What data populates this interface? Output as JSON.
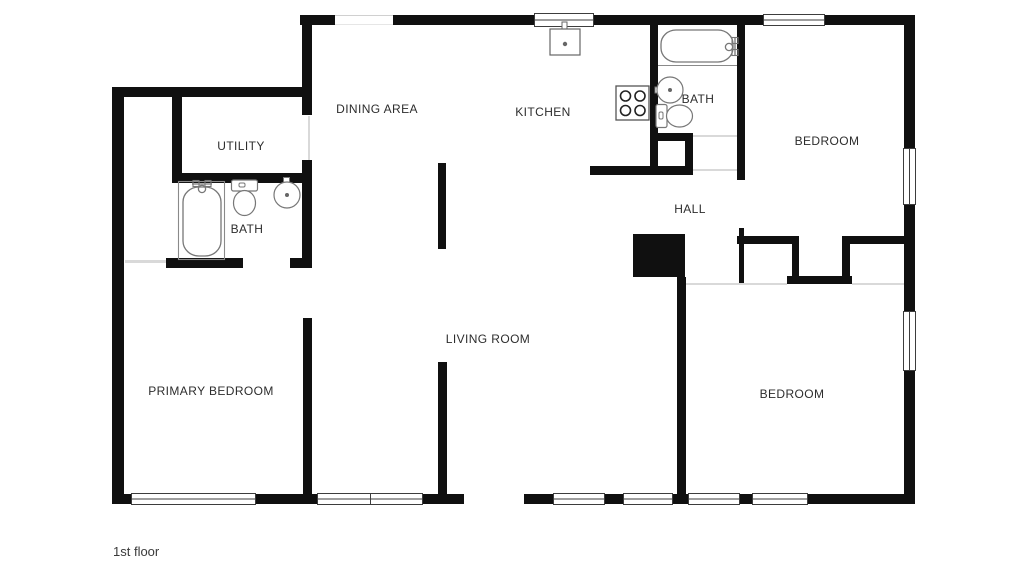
{
  "floor_plan": {
    "floor_label": "1st floor",
    "rooms": [
      {
        "id": "dining-area",
        "label": "DINING AREA"
      },
      {
        "id": "kitchen",
        "label": "KITCHEN"
      },
      {
        "id": "bath-upper",
        "label": "BATH"
      },
      {
        "id": "bedroom-upper",
        "label": "BEDROOM"
      },
      {
        "id": "utility",
        "label": "UTILITY"
      },
      {
        "id": "bath-lower",
        "label": "BATH"
      },
      {
        "id": "hall",
        "label": "HALL"
      },
      {
        "id": "primary-bedroom",
        "label": "PRIMARY BEDROOM"
      },
      {
        "id": "living-room",
        "label": "LIVING ROOM"
      },
      {
        "id": "bedroom-lower",
        "label": "BEDROOM"
      }
    ],
    "fixtures": [
      "bathtub-primary-bath",
      "toilet-primary-bath",
      "sink-primary-bath",
      "bathtub-hall-bath",
      "sink-hall-bath",
      "toilet-hall-bath",
      "kitchen-sink",
      "stove",
      "fireplace"
    ],
    "colors": {
      "wall": "#101010",
      "background": "#ffffff",
      "fixture_outline": "#777777",
      "label_text": "#2d2d2d"
    }
  }
}
